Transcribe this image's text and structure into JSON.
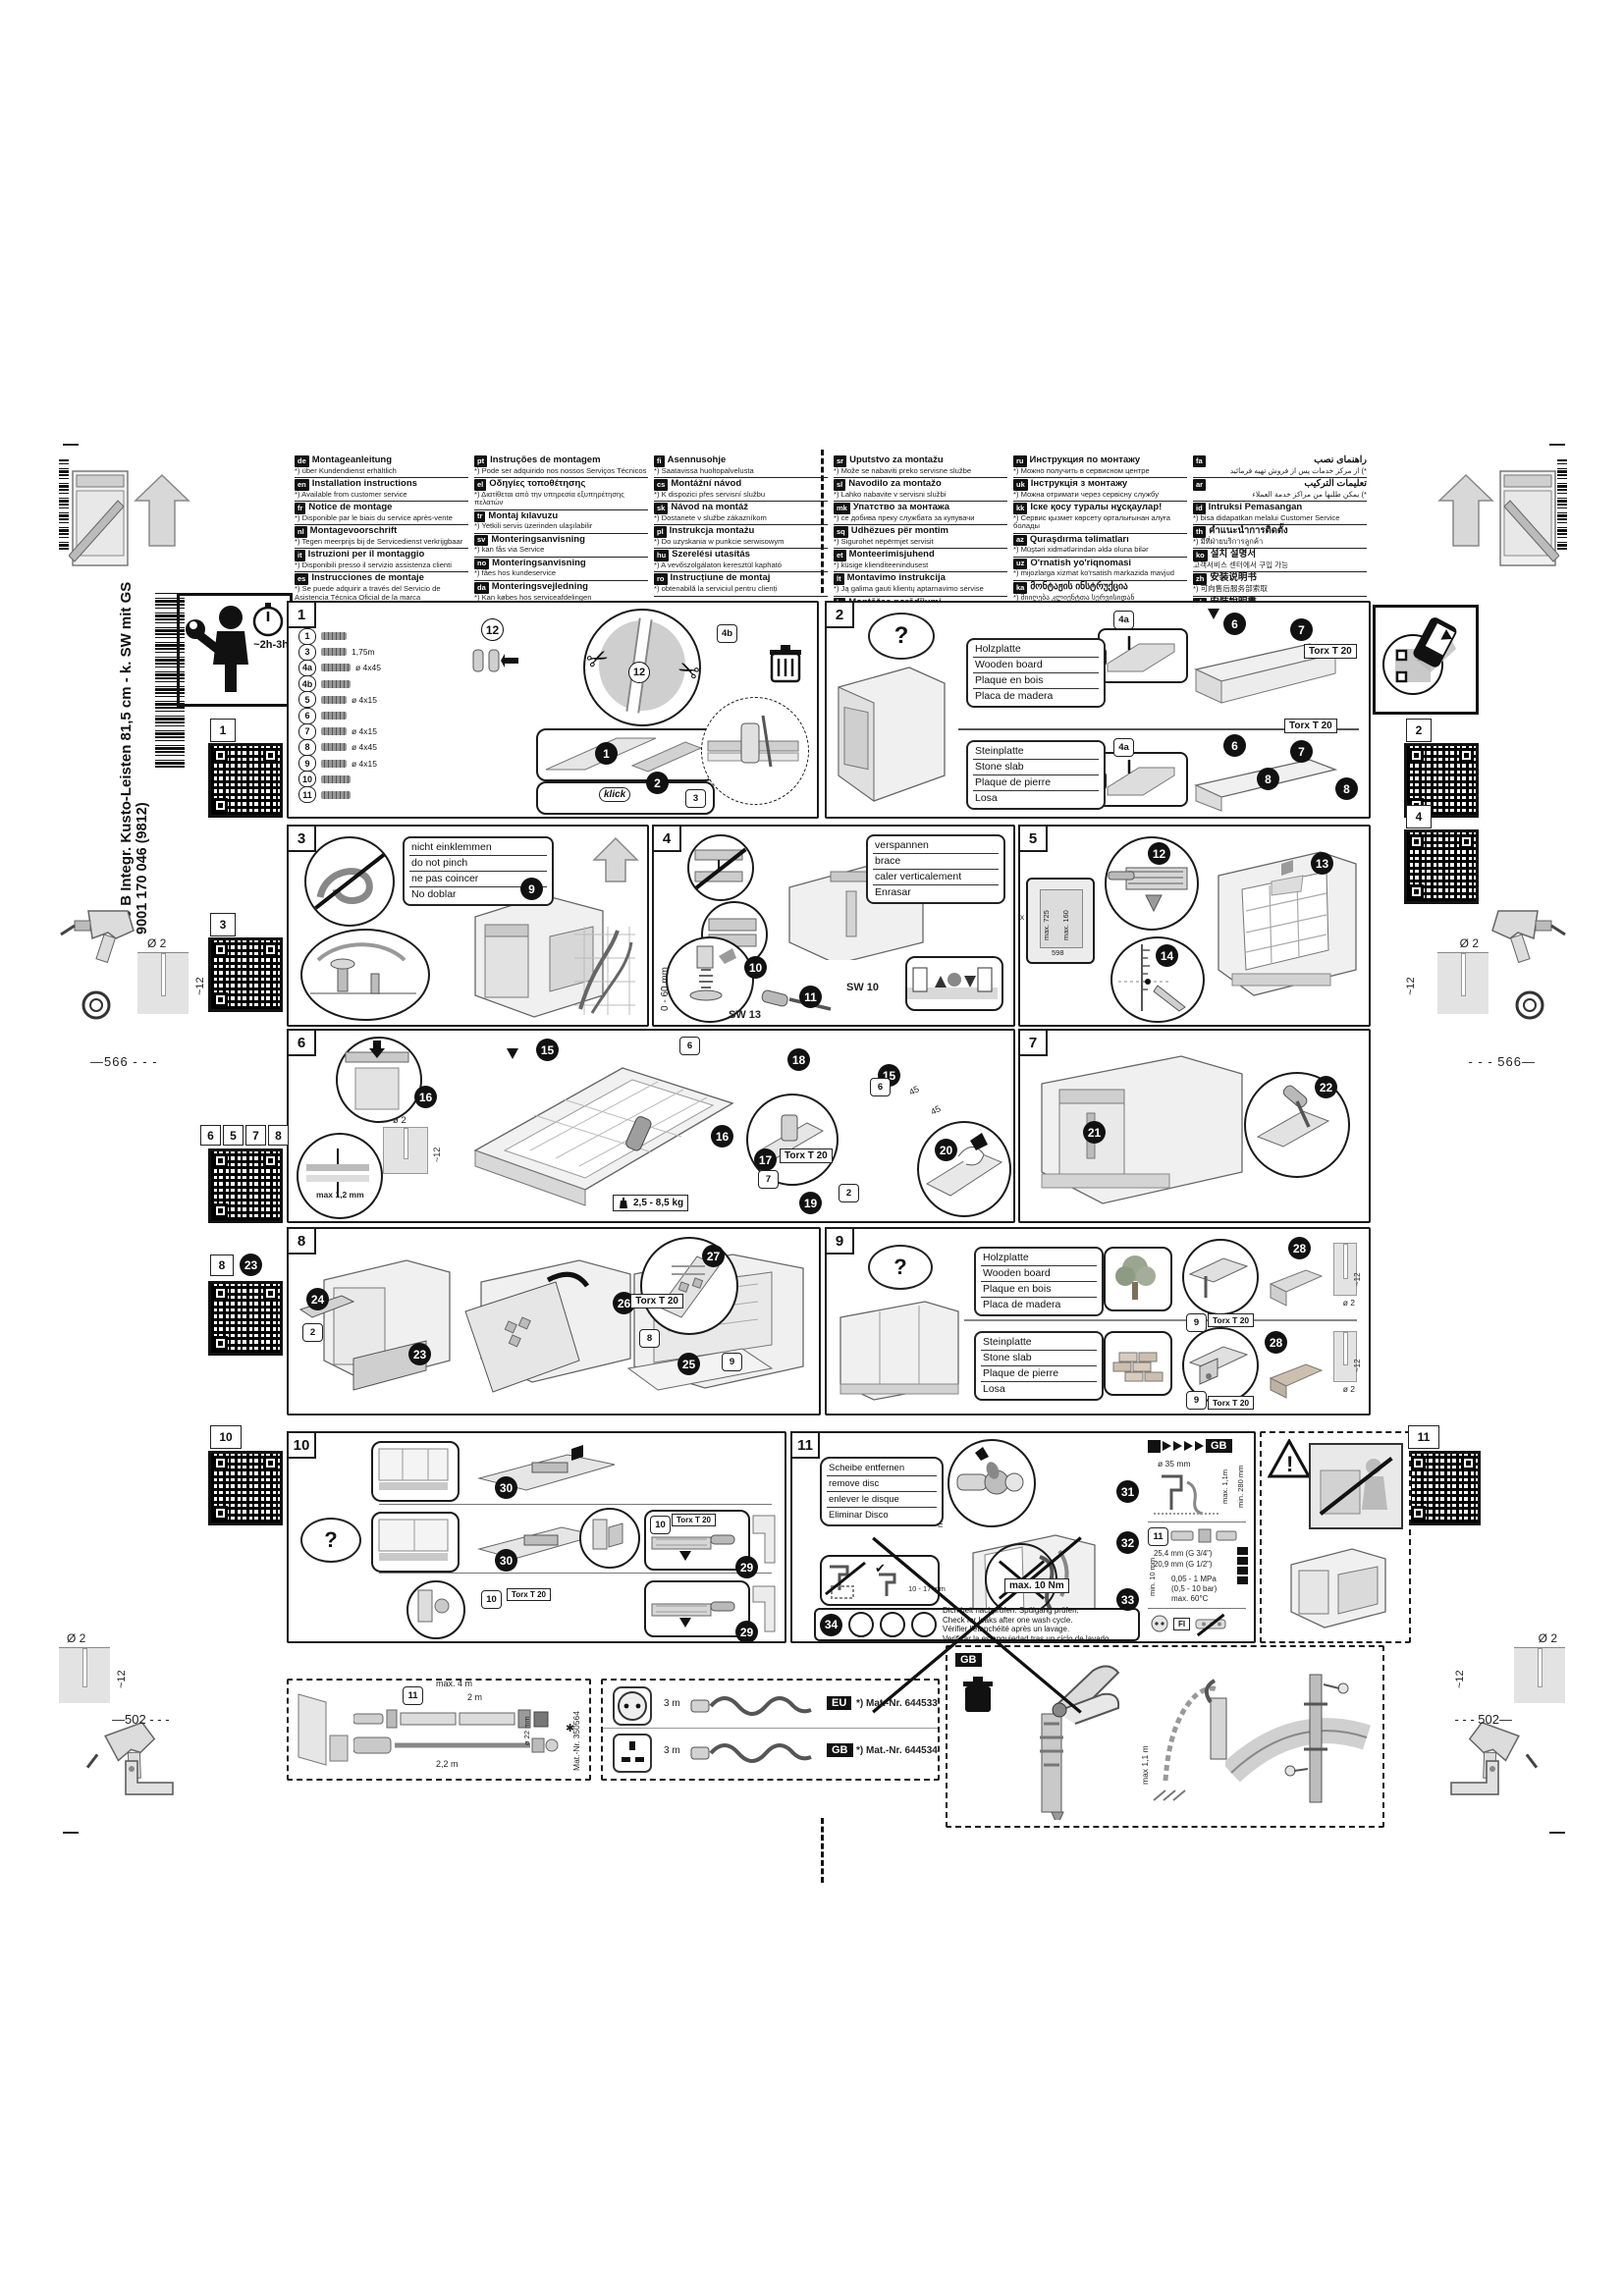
{
  "header": {
    "language_columns": [
      [
        {
          "code": "de",
          "title": "Montageanleitung",
          "note": "*) über Kundendienst erhältlich"
        },
        {
          "code": "en",
          "title": "Installation instructions",
          "note": "*) Available from customer service"
        },
        {
          "code": "fr",
          "title": "Notice de montage",
          "note": "*) Disponible par le biais du service après-vente"
        },
        {
          "code": "nl",
          "title": "Montagevoorschrift",
          "note": "*) Tegen meerprijs bij de Servicedienst verkrijgbaar"
        },
        {
          "code": "it",
          "title": "Istruzioni per il montaggio",
          "note": "*) Disponibili presso il servizio assistenza clienti"
        },
        {
          "code": "es",
          "title": "Instrucciones de montaje",
          "note": "*) Se puede adquirir a través del Servicio de Asistencia Técnica Oficial de la marca"
        }
      ],
      [
        {
          "code": "pt",
          "title": "Instruções de montagem",
          "note": "*) Pode ser adquirido nos nossos Serviços Técnicos"
        },
        {
          "code": "el",
          "title": "Οδηγίες τοποθέτησης",
          "note": "*) Διατίθεται από την υπηρεσία εξυπηρέτησης πελατών"
        },
        {
          "code": "tr",
          "title": "Montaj kılavuzu",
          "note": "*) Yetkili servis üzerinden ulaşılabilir"
        },
        {
          "code": "sv",
          "title": "Monteringsanvisning",
          "note": "*) kan fås via Service"
        },
        {
          "code": "no",
          "title": "Monteringsanvisning",
          "note": "*) fåes hos kundeservice"
        },
        {
          "code": "da",
          "title": "Monteringsvejledning",
          "note": "*) Kan købes hos serviceafdelingen"
        }
      ],
      [
        {
          "code": "fi",
          "title": "Asennusohje",
          "note": "*) Saatavissa huoltopalvelusta"
        },
        {
          "code": "cs",
          "title": "Montážní návod",
          "note": "*) K dispozici přes servisní službu"
        },
        {
          "code": "sk",
          "title": "Návod na montáž",
          "note": "*) Dostanete v službe zákazníkom"
        },
        {
          "code": "pl",
          "title": "Instrukcja montażu",
          "note": "*) Do uzyskania w punkcie serwisowym"
        },
        {
          "code": "hu",
          "title": "Szerelési utasítás",
          "note": "*) A vevőszolgálaton keresztül kapható"
        },
        {
          "code": "ro",
          "title": "Instrucțiune de montaj",
          "note": "*) obtenabilă la serviciul pentru clienți"
        }
      ],
      [
        {
          "code": "sr",
          "title": "Uputstvo za montažu",
          "note": "*) Može se nabaviti preko servisne službe"
        },
        {
          "code": "sl",
          "title": "Navodilo za montažo",
          "note": "*) Lahko nabavite v servisni službi"
        },
        {
          "code": "mk",
          "title": "Упатство за монтажа",
          "note": "*) се добива преку службата за купувачи"
        },
        {
          "code": "sq",
          "title": "Udhëzues për montim",
          "note": "*) Sigurohet nëpërmjet servisit"
        },
        {
          "code": "et",
          "title": "Monteerimisjuhend",
          "note": "*) küsige klienditeenindusest"
        },
        {
          "code": "lt",
          "title": "Montavimo instrukcija",
          "note": "*) Ją galima gauti klientų aptarnavimo servise"
        },
        {
          "code": "lv",
          "title": "Montāžas norādījumi",
          "note": "*) Var saņemt servisa dienestā"
        }
      ],
      [
        {
          "code": "ru",
          "title": "Инструкция по монтажу",
          "note": "*) Можно получить в сервисном центре"
        },
        {
          "code": "uk",
          "title": "Інструкція з монтажу",
          "note": "*) Можна отримати через сервісну службу"
        },
        {
          "code": "kk",
          "title": "Іске қосу туралы нұсқаулар!",
          "note": "*) Сервис қызмет көрсету орталығынан алуға болады"
        },
        {
          "code": "az",
          "title": "Quraşdırma təlimatları",
          "note": "*) Müştəri xidmətlərindən əldə oluna bilər"
        },
        {
          "code": "uz",
          "title": "O'rnatish yo'riqnomasi",
          "note": "*) mijozlarga xizmat ko'rsatish markazida mavjud"
        },
        {
          "code": "ka",
          "title": "მონტაჟის ინსტრუქცია",
          "note": "*) მიიღება კლიენტთა სერვისიდან"
        },
        {
          "code": "bg",
          "title": "Ръководство за монтаж",
          "note": "*) Получавате го в сервиза"
        }
      ],
      [
        {
          "code": "fa",
          "title": "راهنمای نصب",
          "note": "*) از مرکز خدمات پس از فروش تهیه فرمائید",
          "rtl": true
        },
        {
          "code": "ar",
          "title": "تعليمات التركيب",
          "note": "*) يمكن طلبها من مراكز خدمة العملاء",
          "rtl": true
        },
        {
          "code": "id",
          "title": "Intruksi Pemasangan",
          "note": "*) bisa didapatkan melalui Customer Service"
        },
        {
          "code": "th",
          "title": "คำแนะนำการติดตั้ง",
          "note": "*) มีที่ฝ่ายบริการลูกค้า"
        },
        {
          "code": "ko",
          "title": "설치 설명서",
          "note": "고객서비스 센터에서 구입 가능"
        },
        {
          "code": "zh",
          "title": "安装说明书",
          "note": "*) 可向售后服务部索取"
        },
        {
          "code": "zh",
          "title": "安裝說明書",
          "note": "*) 可向售後服務部索取"
        }
      ]
    ]
  },
  "side": {
    "product": "640 B Integr. Kusto-Leisten 81,5 cm - k. SW mit GS",
    "code": "9001 170 046 (9812)"
  },
  "time_badge": "~2h-3h",
  "qr": {
    "l1": "1",
    "r2": "2",
    "l3": "3",
    "r4": "4",
    "mid": [
      "6",
      "5",
      "7",
      "8"
    ],
    "s8": [
      "8",
      "23"
    ],
    "l10": "10",
    "r11": "11"
  },
  "drill": {
    "bit": "Ø 2",
    "depth": "~12",
    "top": "566",
    "bottom": "502"
  },
  "panels": {
    "p1": {
      "no": "1",
      "parts": [
        {
          "id": "1",
          "spec": ""
        },
        {
          "id": "3",
          "spec": "1,75m"
        },
        {
          "id": "4a",
          "spec": "ø 4x45"
        },
        {
          "id": "4b",
          "spec": ""
        },
        {
          "id": "5",
          "spec": "ø 4x15"
        },
        {
          "id": "6",
          "spec": ""
        },
        {
          "id": "7",
          "spec": "ø 4x15"
        },
        {
          "id": "8",
          "spec": "ø 4x45"
        },
        {
          "id": "9",
          "spec": "ø 4x15"
        },
        {
          "id": "10",
          "spec": ""
        },
        {
          "id": "11",
          "spec": ""
        }
      ],
      "plug": "12",
      "s1": "1",
      "s2": "2",
      "s3": "3",
      "klick": "klick"
    },
    "p2": {
      "no": "2",
      "q": "?",
      "wood": [
        "Holzplatte",
        "Wooden board",
        "Plaque en bois",
        "Placa de madera"
      ],
      "stone": [
        "Steinplatte",
        "Stone slab",
        "Plaque de pierre",
        "Losa"
      ],
      "torx": "Torx T 20",
      "b4a": "4a",
      "b4b": "4b",
      "m6": "6",
      "m7": "7",
      "m8": "8"
    },
    "p3": {
      "no": "3",
      "warn": [
        "nicht einklemmen",
        "do not pinch",
        "ne pas coincer",
        "No doblar"
      ],
      "m9": "9"
    },
    "p4": {
      "no": "4",
      "brace": [
        "verspannen",
        "brace",
        "caler verticalement",
        "Enrasar"
      ],
      "range": "0 - 60 mm",
      "sw13": "SW 13",
      "sw10": "SW 10",
      "m10": "10",
      "m11": "11"
    },
    "p5": {
      "no": "5",
      "m12": "12",
      "m13": "13",
      "m14": "14",
      "w": "598",
      "h1": "max. 725",
      "h2": "max. 160",
      "x": "x"
    },
    "p6": {
      "no": "6",
      "m15": "15",
      "m16": "16",
      "m17": "17",
      "m18": "18",
      "m19": "19",
      "m20": "20",
      "drill": "ø 2",
      "depth": "~12",
      "gap": "max 1,2 mm",
      "weight": "2,5 - 8,5 kg",
      "torx": "Torx T 20",
      "b6": "6",
      "b7": "7",
      "b2": "2",
      "a45": "45"
    },
    "p7": {
      "no": "7",
      "m21": "21",
      "m22": "22"
    },
    "p8": {
      "no": "8",
      "m23": "23",
      "m24": "24",
      "m25": "25",
      "m26": "26",
      "m27": "27",
      "b2": "2",
      "b8": "8",
      "b9": "9",
      "torx": "Torx T 20"
    },
    "p9": {
      "no": "9",
      "q": "?",
      "wood": [
        "Holzplatte",
        "Wooden board",
        "Plaque en bois",
        "Placa de madera"
      ],
      "stone": [
        "Steinplatte",
        "Stone slab",
        "Plaque de pierre",
        "Losa"
      ],
      "m28": "28",
      "b9": "9",
      "torx": "Torx T 20",
      "drill": "ø 2",
      "depth": "~12"
    },
    "p10": {
      "no": "10",
      "q": "?",
      "m29": "29",
      "m30": "30",
      "b10": "10",
      "torx": "Torx T 20"
    },
    "p11": {
      "no": "11",
      "disc": [
        "Scheibe entfernen",
        "remove disc",
        "enlever le disque",
        "Eliminar Disco"
      ],
      "min5": "min. 5 - 10 mm",
      "nm": "max. 10 Nm",
      "clamp": "10 - 17 mm",
      "m31": "31",
      "m32": "32",
      "m33": "33",
      "m34": "34",
      "gb": "GB",
      "dia": "ø 35 mm",
      "hmax": "max. 1,1m",
      "hmin": "min. 280 mm",
      "b11": "11",
      "g34": "25,4 mm (G 3/4\")",
      "g12": "20,9 mm (G 1/2\")",
      "min10": "min. 10 mm",
      "press1": "0,05 - 1 MPa",
      "press2": "(0,5 - 10 bar)",
      "press3": "max. 60°C",
      "fi": "FI",
      "leak": [
        "Dichtheit nachprüfen: Spülgang prüfen.",
        "Check for leaks after one wash cycle.",
        "Vérifier l'étanchéité après un lavage.",
        "Verificar la estanquiedad tras un ciclo de lavado."
      ]
    },
    "warn_panel": {
      "bang": "!"
    },
    "hose": {
      "l4": "max. 4 m",
      "l2": "2 m",
      "l22": "2,2 m",
      "dia": "ø 22 mm",
      "mat": "Mat.-Nr. 350564",
      "b11": "11",
      "star": "✱"
    },
    "cords": {
      "eu": "EU",
      "eu_len": "3 m",
      "eu_mat": "*) Mat.-Nr. 644523",
      "eu_mat2": "*) Mat.-Nr. 644533",
      "gb": "GB",
      "gb_len": "3 m",
      "gb_mat": "*) Mat.-Nr. 644534"
    },
    "gbp": {
      "badge": "GB",
      "hmax": "max 1,1 m"
    }
  }
}
